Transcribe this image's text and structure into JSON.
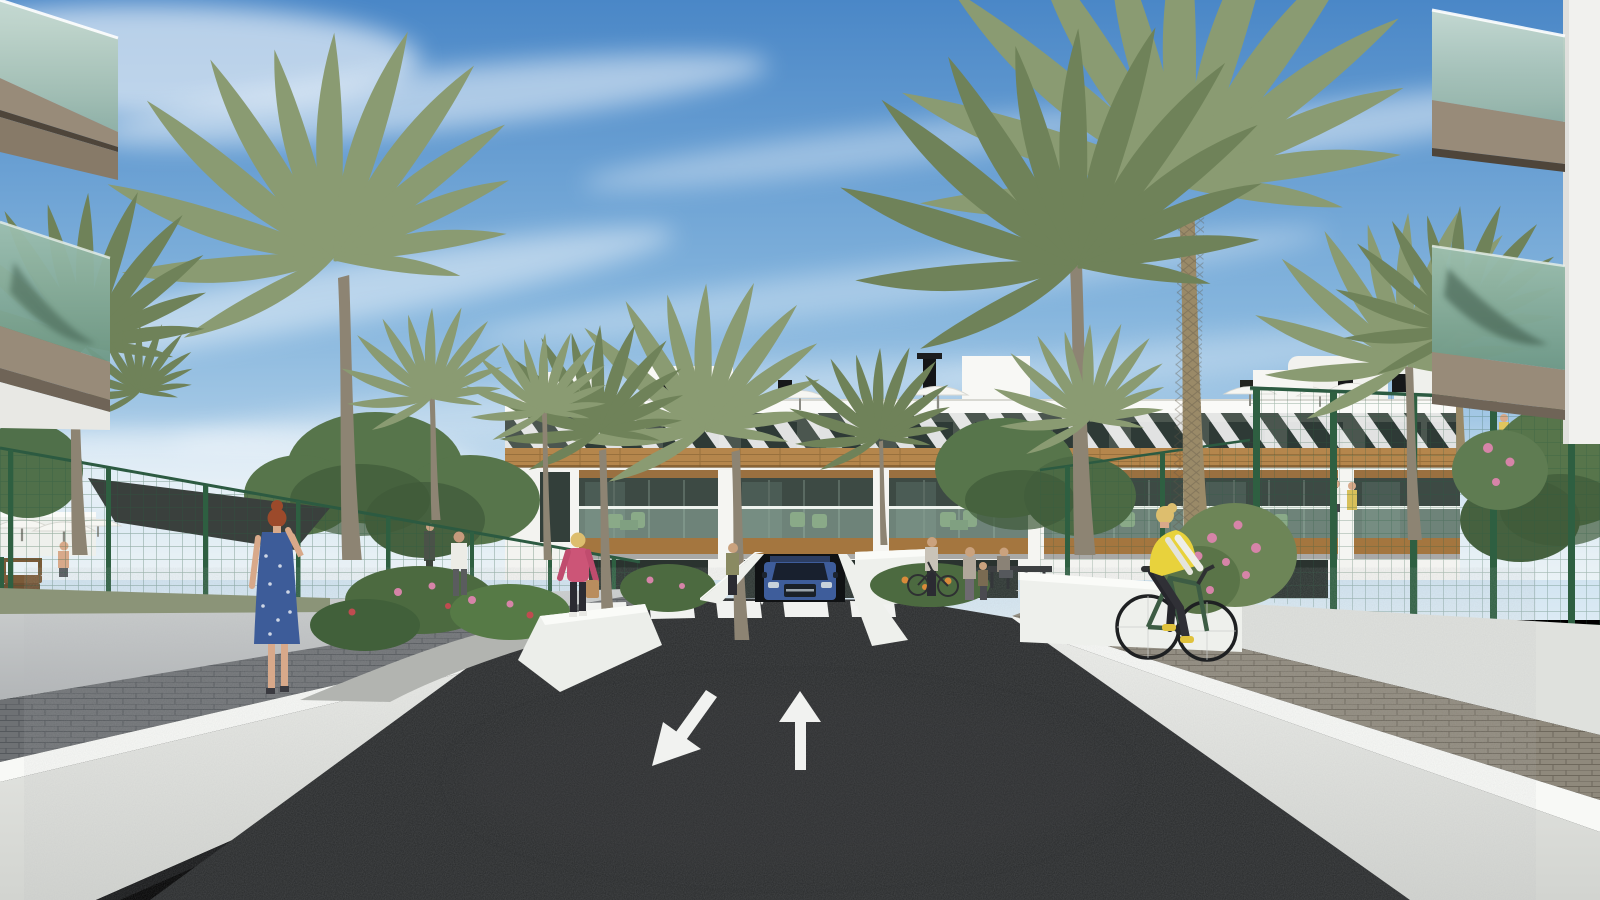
{
  "scene": {
    "type": "architectural-render",
    "description": "3D architectural rendering of a modern white apartment complex: a two-lane asphalt road with painted direction arrows leads to an underground parking ramp with a blue SUV emerging, a zebra crosswalk, white boundary walls, green mesh fences, palm trees, flowering gardens, pedestrians and a cyclist under a blue sky with cirrus clouds",
    "objects": [
      "blue sky with cirrus clouds",
      "white three-storey apartment building with wood cladding and diagonal pergola slats",
      "rooftop terraces with white parasols and black chimneys",
      "underground parking ramp with blue SUV",
      "pedestrian crosswalk",
      "asphalt road with up and down lane arrows",
      "white boundary walls with bright copings",
      "green mesh garden fences",
      "palm trees",
      "flowering shrubs",
      "dark shade sail over pool area",
      "woman in blue polka-dot dress walking on left sidewalk",
      "woman in pink jacket with handbag",
      "man in white t-shirt walking away",
      "cyclist in yellow vest on right sidewalk",
      "pedestrians and child near crosswalk",
      "glass balconies in the foreground corners"
    ]
  },
  "palette": {
    "sky_top": "#4a87c7",
    "sky_mid": "#85b5dd",
    "sky_horizon": "#dcebf4",
    "cloud": "#ffffff",
    "building_white": "#f3f3f0",
    "parapet": "#fafaf8",
    "pergola_dark": "#4b564f",
    "window_dark": "#2e3a36",
    "wood": "#b5864c",
    "wood_parapet": "#a4763f",
    "terrace_shadow": "#3d4a44",
    "furniture_green": "#6f9160",
    "glass_light": "#aac9bb",
    "glass_dark": "#6e9886",
    "fascia_taupe": "#988b79",
    "fascia_dark": "#6f6457",
    "fence_green": "#2e5f41",
    "mesh_green": "#35604a",
    "palm_green": "#8a9b72",
    "palm_dark": "#6f8259",
    "tree_green": "#57754b",
    "tree_dark": "#3f5a39",
    "bush_green": "#4c6a40",
    "flower_pink": "#d684a8",
    "flower_red": "#c04b50",
    "flower_orange": "#d98b3a",
    "trunk_gray": "#8d8473",
    "trunk_tan": "#9a8a68",
    "sail_dark": "#3a403d",
    "road_asphalt": "#27292a",
    "marking_white": "#f1f2f0",
    "wall_white": "#e9eae6",
    "coping_white": "#f8f9f6",
    "wall_gray": "#c2c5c6",
    "paver_left": "#6e7174",
    "paver_right": "#8f897c",
    "grass": "#8b9478",
    "suv_blue": "#3e5d9b",
    "suv_dark": "#18202e",
    "skin": "#d8a98a",
    "hair_red": "#9c4a2b",
    "hair_blonde": "#ddbe6e",
    "dress_blue": "#3d5c99",
    "jacket_pink": "#cc5577",
    "vest_yellow": "#e8d23c",
    "shirt_white": "#ecece6",
    "pants_dark": "#2b2b32",
    "bike_green": "#3d5c44"
  }
}
